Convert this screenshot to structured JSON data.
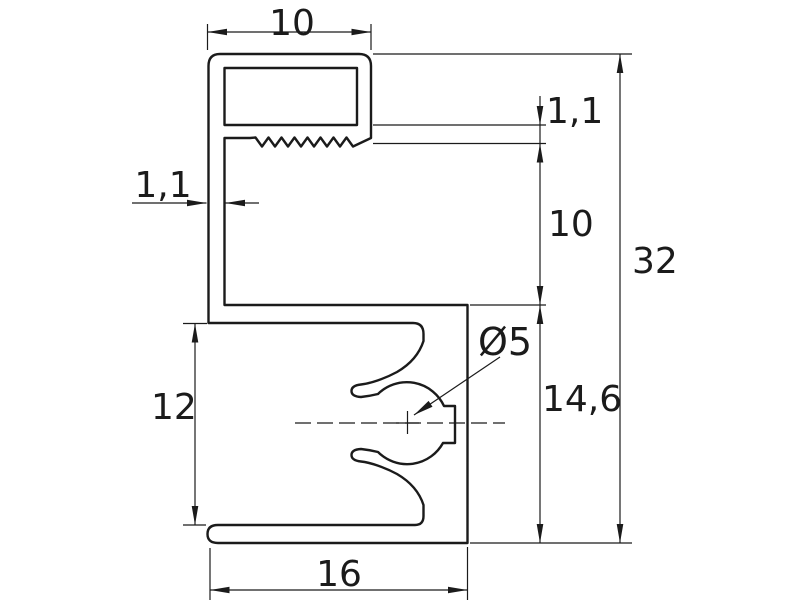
{
  "drawing": {
    "type": "technical-profile-cross-section",
    "dimensions": {
      "top_width": "10",
      "wall_thickness": "1,1",
      "lip_thickness": "1,1",
      "hook_depth": "10",
      "total_height": "32",
      "body_height": "14,6",
      "opening_height": "12",
      "bottom_width": "16",
      "hole_diameter": "Ø5"
    },
    "colors": {
      "line": "#1b1b1b",
      "background": "#ffffff"
    }
  }
}
